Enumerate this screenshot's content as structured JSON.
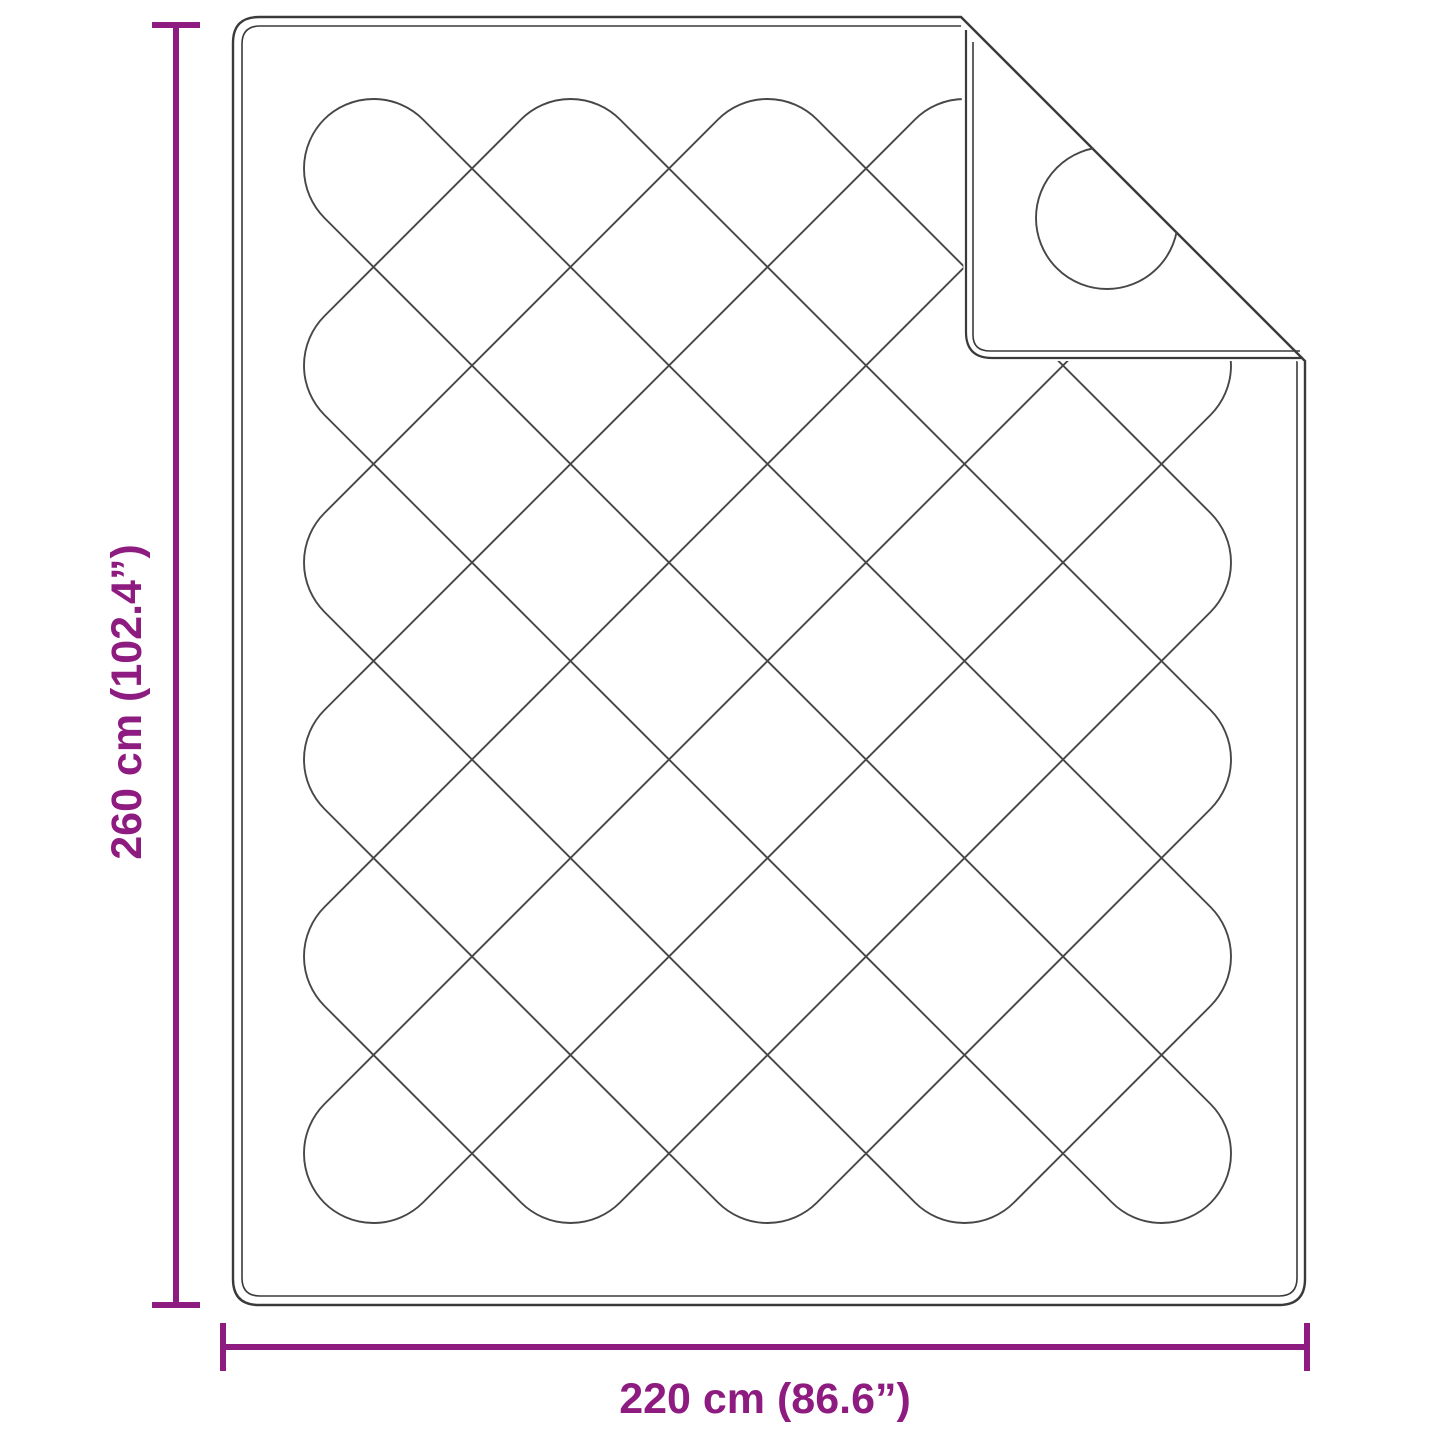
{
  "diagram": {
    "type": "product-dimension-diagram",
    "product": "quilted-blanket-with-folded-corner",
    "height_label": "260 cm (102.4”)",
    "width_label": "220 cm (86.6”)",
    "accent_color": "#8e1b80",
    "line_color": "#3a3a3a",
    "quilt_line_color": "#474747",
    "background": "#ffffff"
  }
}
